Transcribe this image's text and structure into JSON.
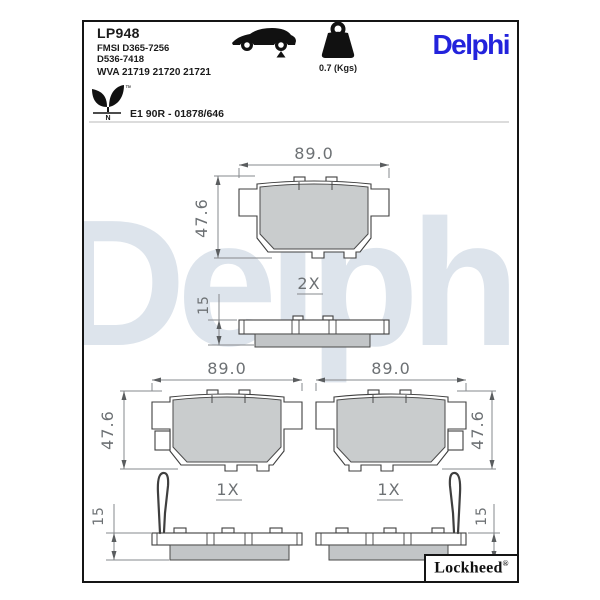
{
  "sheet": {
    "part_number": "LP948",
    "fmsi_line1": "FMSI D365-7256",
    "fmsi_line2": "D536-7418",
    "wva_line": "WVA 21719 21720 21721",
    "weight": "0.7 (Kgs)",
    "brand": "Delphi",
    "approval": "E1 90R - 01878/646",
    "eco_mark_letter": "N",
    "eco_trademark": "™",
    "footer_brand": "Lockheed",
    "footer_registered": "®"
  },
  "drawing": {
    "watermark": "Delphi",
    "views": {
      "top": {
        "qty": "2X",
        "width": "89.0",
        "height": "47.6",
        "thickness": "15"
      },
      "bottom_left": {
        "qty": "1X",
        "width": "89.0",
        "height": "47.6",
        "thickness": "15"
      },
      "bottom_right": {
        "qty": "1X",
        "width": "89.0",
        "height": "47.6",
        "thickness": "15"
      }
    }
  },
  "colors": {
    "logo_blue": "#2323dc",
    "watermark_blue": "#dde4ec",
    "pad_gray": "#c9cccd",
    "pad_side_gray": "#c2c5c7",
    "dim_gray": "#6d7174",
    "outline": "#3f3f3f"
  }
}
